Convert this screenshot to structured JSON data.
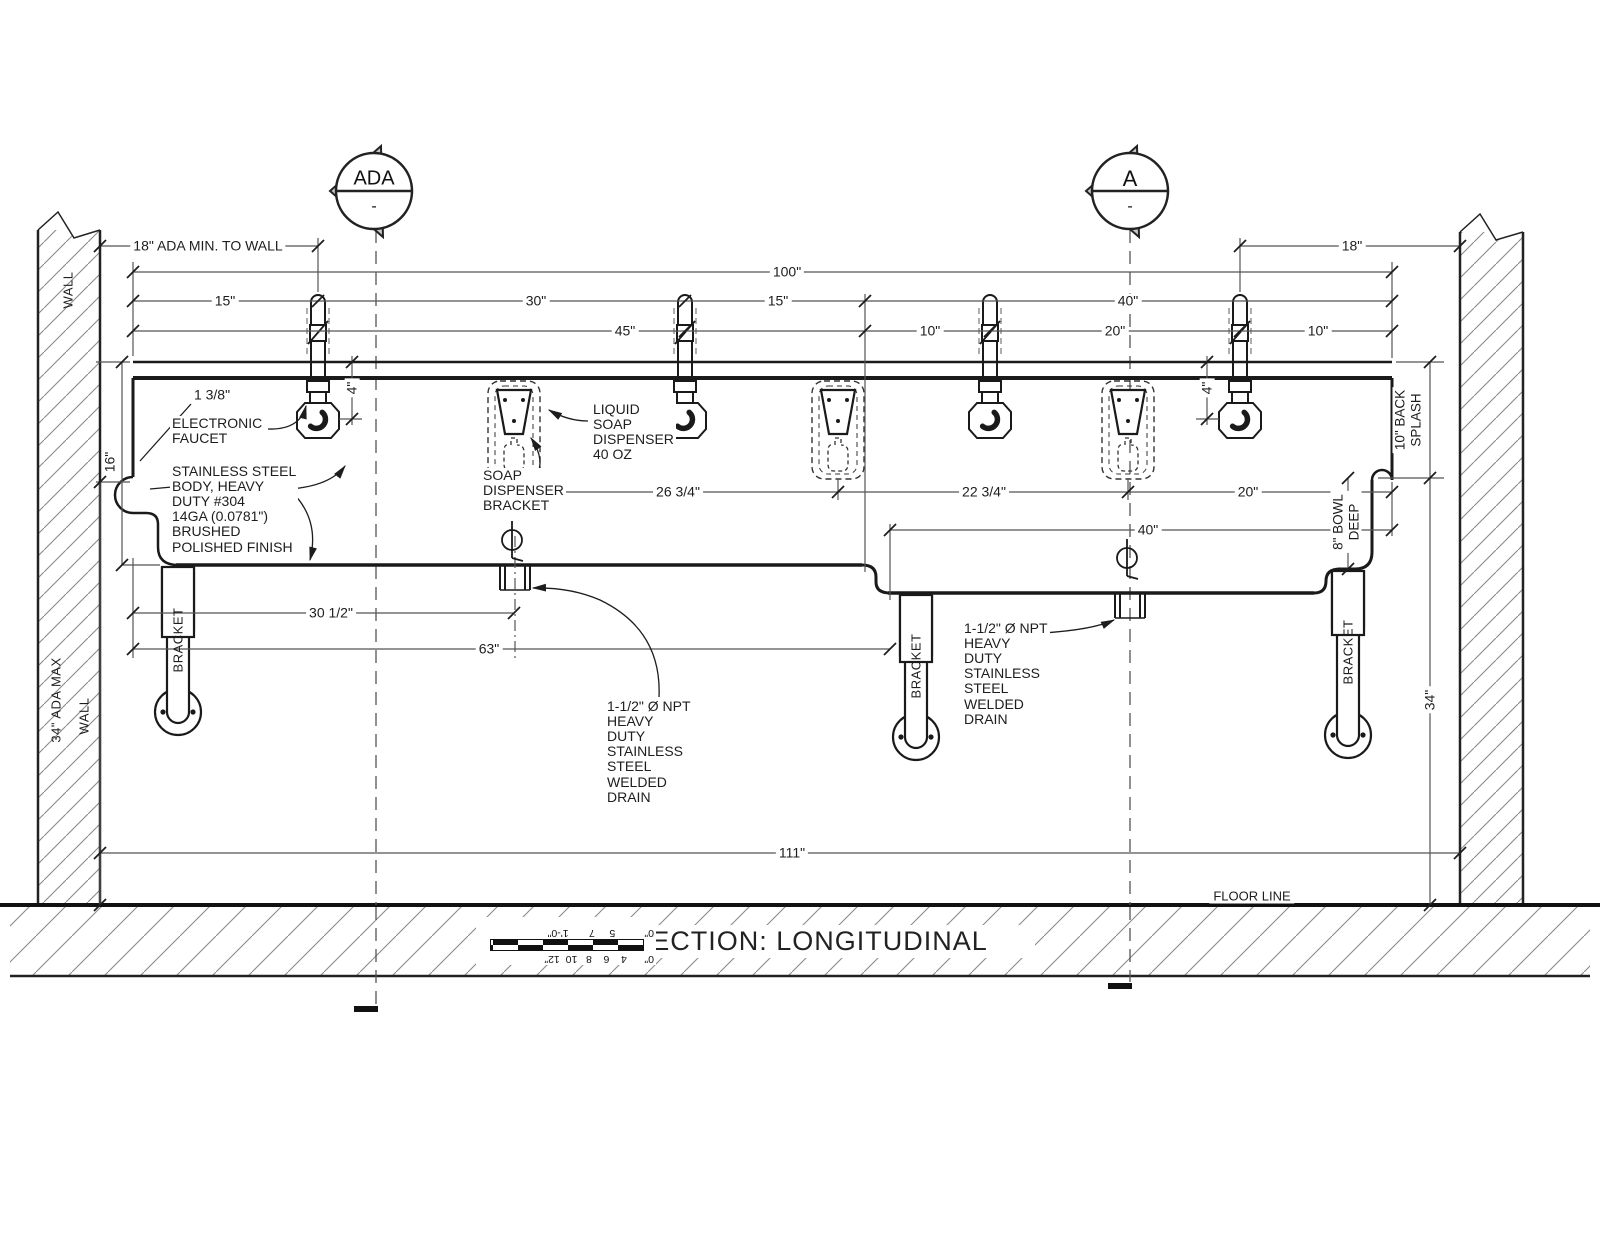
{
  "markers": {
    "ada": {
      "title": "ADA",
      "sub": "-"
    },
    "a": {
      "title": "A",
      "sub": "-"
    }
  },
  "dims": {
    "ada_min_wall": "18\" ADA MIN. TO WALL",
    "right_to_wall": "18\"",
    "overall": "100\"",
    "d15_left": "15\"",
    "d30": "30\"",
    "d15_mid": "15\"",
    "d40_top": "40\"",
    "d45": "45\"",
    "d10_left": "10\"",
    "d20_top": "20\"",
    "d10_right": "10\"",
    "d4_left": "4\"",
    "d4_right": "4\"",
    "d16": "16\"",
    "d26_34": "26 3/4\"",
    "d22_34": "22 3/4\"",
    "d20_right": "20\"",
    "d40_mid": "40\"",
    "d30_12": "30 1/2\"",
    "d63": "63\"",
    "d111": "111\"",
    "d34_right": "34\"",
    "back_splash": "10\" BACK\nSPLASH",
    "bowl_deep": "8\" BOWL\nDEEP",
    "ada_max": "34\" ADA MAX"
  },
  "labels": {
    "wall_top": "WALL",
    "wall_bottom": "WALL",
    "bracket": "BRACKET",
    "floor_line": "FLOOR LINE",
    "title": "SECTION: LONGITUDINAL"
  },
  "notes": {
    "faucet_size": "1 3/8\"",
    "electronic_faucet": "ELECTRONIC\nFAUCET",
    "body": "STAINLESS STEEL\nBODY, HEAVY\nDUTY #304\n14GA (0.0781\")\nBRUSHED\nPOLISHED FINISH",
    "liquid_soap": "LIQUID\nSOAP\nDISPENSER\n40 OZ",
    "soap_bracket": "SOAP\nDISPENSER\nBRACKET",
    "drain": "1-1/2\" Ø NPT\nHEAVY\nDUTY\nSTAINLESS\nSTEEL\nWELDED\nDRAIN"
  },
  "scale_bar": {
    "top": "0\"      4    6    8   10  12\"",
    "bottom": "0\"          5     7       1'-0\""
  }
}
